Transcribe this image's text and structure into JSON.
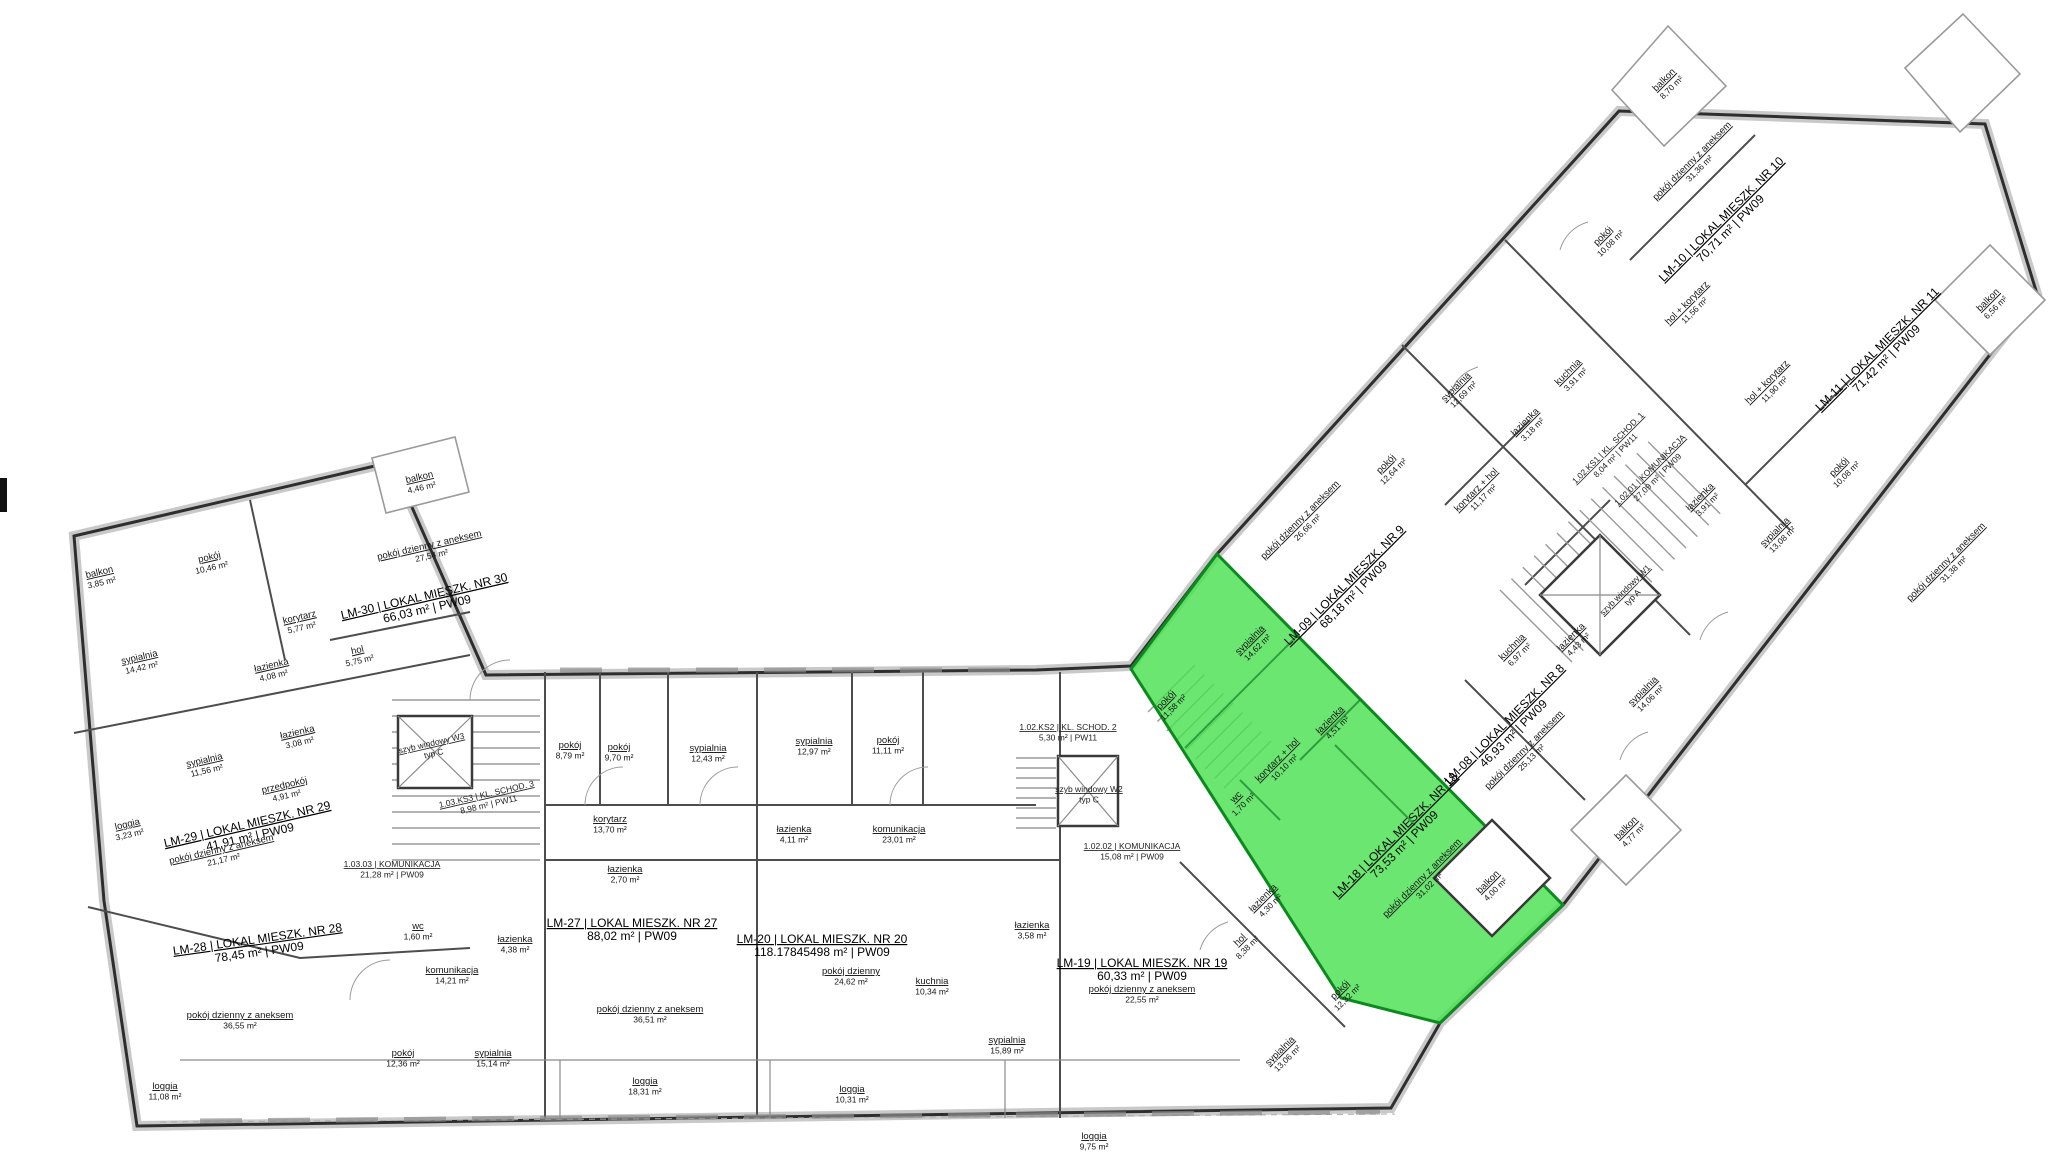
{
  "page": {
    "background": "#ffffff"
  },
  "colors": {
    "highlight_fill": "#49e052",
    "highlight_stroke": "#0c8a1e",
    "wall": "#2e2e2e"
  },
  "highlighted_unit": "lm18",
  "units": {
    "lm30": {
      "title": "LM-30 | LOKAL MIESZK. NR 30",
      "area": "66,03 m² | PW09",
      "rooms": {
        "balkon1": {
          "n": "balkon",
          "a": "4,46 m²"
        },
        "balkon2": {
          "n": "balkon",
          "a": "3,85 m²"
        },
        "pokoj": {
          "n": "pokój",
          "a": "10,46 m²"
        },
        "sypialnia": {
          "n": "sypialnia",
          "a": "14,42 m²"
        },
        "korytarz": {
          "n": "korytarz",
          "a": "5,77 m²"
        },
        "lazienka": {
          "n": "łazienka",
          "a": "4,08 m²"
        },
        "hol": {
          "n": "hol",
          "a": "5,75 m²"
        },
        "dzienny": {
          "n": "pokój dzienny z aneksem",
          "a": "27,54 m²"
        }
      }
    },
    "lm29": {
      "title": "LM-29 | LOKAL MIESZK. NR 29",
      "area": "41,91 m² | PW09",
      "rooms": {
        "sypialnia": {
          "n": "sypialnia",
          "a": "11,56 m²"
        },
        "lazienka": {
          "n": "łazienka",
          "a": "3,08 m²"
        },
        "przedpokoj": {
          "n": "przedpokój",
          "a": "4,91 m²"
        },
        "dzienny": {
          "n": "pokój dzienny z aneksem",
          "a": "21,17 m²"
        },
        "loggia": {
          "n": "loggia",
          "a": "3,23 m²"
        }
      }
    },
    "lm28": {
      "title": "LM-28 | LOKAL MIESZK. NR 28",
      "area": "78,45 m² | PW09",
      "rooms": {
        "dzienny": {
          "n": "pokój dzienny z aneksem",
          "a": "36,55 m²"
        },
        "loggia": {
          "n": "loggia",
          "a": "11,08 m²"
        },
        "wc": {
          "n": "wc",
          "a": "1,60 m²"
        },
        "lazienka": {
          "n": "łazienka",
          "a": "4,38 m²"
        },
        "komunikacja": {
          "n": "komunikacja",
          "a": "14,21 m²"
        },
        "pokoj": {
          "n": "pokój",
          "a": "12,36 m²"
        },
        "sypialnia": {
          "n": "sypialnia",
          "a": "15,14 m²"
        }
      }
    },
    "lm27": {
      "title": "LM-27 | LOKAL MIESZK. NR 27",
      "area": "88,02 m² | PW09",
      "rooms": {
        "pokoj1": {
          "n": "pokój",
          "a": "8,79 m²"
        },
        "pokoj2": {
          "n": "pokój",
          "a": "9,70 m²"
        },
        "sypialnia": {
          "n": "sypialnia",
          "a": "12,43 m²"
        },
        "korytarz": {
          "n": "korytarz",
          "a": "13,70 m²"
        },
        "lazienka": {
          "n": "łazienka",
          "a": "2,70 m²"
        },
        "dzienny": {
          "n": "pokój dzienny z aneksem",
          "a": "36,51 m²"
        },
        "loggia": {
          "n": "loggia",
          "a": "18,31 m²"
        }
      }
    },
    "lm20": {
      "title": "LM-20 | LOKAL MIESZK. NR 20",
      "area": "118.17845498 m² | PW09",
      "rooms": {
        "sypialnia1": {
          "n": "sypialnia",
          "a": "12,97 m²"
        },
        "pokoj": {
          "n": "pokój",
          "a": "11,11 m²"
        },
        "lazienka1": {
          "n": "łazienka",
          "a": "4,11 m²"
        },
        "komunikacja": {
          "n": "komunikacja",
          "a": "23,01 m²"
        },
        "dzienny": {
          "n": "pokój dzienny",
          "a": "24,62 m²"
        },
        "kuchnia": {
          "n": "kuchnia",
          "a": "10,34 m²"
        },
        "lazienka2": {
          "n": "łazienka",
          "a": "3,58 m²"
        },
        "sypialnia2": {
          "n": "sypialnia",
          "a": "15,89 m²"
        },
        "loggia": {
          "n": "loggia",
          "a": "10,31 m²"
        }
      }
    },
    "lm19": {
      "title": "LM-19 | LOKAL MIESZK. NR 19",
      "area": "60,33 m² | PW09",
      "rooms": {
        "dzienny": {
          "n": "pokój dzienny z aneksem",
          "a": "22,55 m²"
        },
        "lazienka": {
          "n": "łazienka",
          "a": "4,30 m²"
        },
        "hol": {
          "n": "hol",
          "a": "8,38 m²"
        },
        "pokoj": {
          "n": "pokój",
          "a": "12,32 m²"
        },
        "sypialnia": {
          "n": "sypialnia",
          "a": "13,06 m²"
        },
        "loggia": {
          "n": "loggia",
          "a": "9,75 m²"
        }
      }
    },
    "lm18": {
      "title": "LM-18 | LOKAL MIESZK. NR 18",
      "area": "73,53 m² | PW09",
      "rooms": {
        "sypialnia": {
          "n": "sypialnia",
          "a": "14,62 m²"
        },
        "pokoj": {
          "n": "pokój",
          "a": "11,58 m²"
        },
        "korytarz": {
          "n": "korytarz + hol",
          "a": "10,10 m²"
        },
        "wc": {
          "n": "wc",
          "a": "1,70 m²"
        },
        "lazienka": {
          "n": "łazienka",
          "a": "4,51 m²"
        },
        "dzienny": {
          "n": "pokój dzienny z aneksem",
          "a": "31,02 m²"
        },
        "balkon": {
          "n": "balkon",
          "a": "4,00 m²"
        }
      }
    },
    "lm10": {
      "title": "LM-10 | LOKAL MIESZK. NR 10",
      "area": "70,71 m² | PW09",
      "rooms": {
        "balkon": {
          "n": "balkon",
          "a": "8,70 m²"
        },
        "dzienny": {
          "n": "pokój dzienny z aneksem",
          "a": "31,36 m²"
        },
        "pokoj": {
          "n": "pokój",
          "a": "10,08 m²"
        },
        "hol": {
          "n": "hol + korytarz",
          "a": "11,56 m²"
        }
      }
    },
    "lm11": {
      "title": "LM-11 | LOKAL MIESZK. NR 11",
      "area": "71,42 m² | PW09",
      "rooms": {
        "balkon": {
          "n": "balkon",
          "a": "6,56 m²"
        },
        "hol": {
          "n": "hol + korytarz",
          "a": "11,90 m²"
        },
        "pokoj": {
          "n": "pokój",
          "a": "10,08 m²"
        },
        "sypialnia": {
          "n": "sypialnia",
          "a": "13,08 m²"
        },
        "lazienka": {
          "n": "łazienka",
          "a": "3,91 m²"
        },
        "dzienny": {
          "n": "pokój dzienny z aneksem",
          "a": "31,38 m²"
        }
      }
    },
    "lm09": {
      "title": "LM-09 | LOKAL MIESZK. NR 9",
      "area": "68,18 m² | PW09",
      "rooms": {
        "dzienny": {
          "n": "pokój dzienny z aneksem",
          "a": "26,66 m²"
        },
        "sypialnia": {
          "n": "sypialnia",
          "a": "12,69 m²"
        },
        "pokoj": {
          "n": "pokój",
          "a": "12,64 m²"
        },
        "kuchnia": {
          "n": "kuchnia",
          "a": "3,91 m²"
        },
        "lazienka": {
          "n": "łazienka",
          "a": "3,18 m²"
        },
        "korytarz": {
          "n": "korytarz + hol",
          "a": "11,17 m²"
        }
      }
    },
    "lm08": {
      "title": "LM-08 | LOKAL MIESZK. NR 8",
      "area": "46,93 m² | PW09",
      "rooms": {
        "dzienny": {
          "n": "pokój dzienny z aneksem",
          "a": "25,13 m²"
        },
        "sypialnia": {
          "n": "sypialnia",
          "a": "14,06 m²"
        },
        "lazienka": {
          "n": "łazienka",
          "a": "4,43 m²"
        },
        "kuchnia": {
          "n": "kuchnia",
          "a": "6,97 m²"
        },
        "balkon": {
          "n": "balkon",
          "a": "4,77 m²"
        }
      }
    }
  },
  "circ": {
    "kom103": {
      "t1": "1.03.03 | KOMUNIKACJA",
      "t2": "21,28 m² | PW09"
    },
    "ks3": {
      "t1": "1.03.KS3 | KL. SCHOD. 3",
      "t2": "8,98 m² | PW11"
    },
    "w3": {
      "t1": "szyb windowy W3",
      "t2": "typ C"
    },
    "ks2": {
      "t1": "1.02.KS2 | KL. SCHOD. 2",
      "t2": "5,30 m² | PW11"
    },
    "w2": {
      "t1": "szyb windowy W2",
      "t2": "typ C"
    },
    "kom102": {
      "t1": "1.02.02 | KOMUNIKACJA",
      "t2": "15,08 m² | PW09"
    },
    "ks1": {
      "t1": "1.02.KS1 | KL. SCHOD. 1",
      "t2": "8,04 m² | PW11"
    },
    "kom1021": {
      "t1": "1.02.01 | KOMUNIKACJA",
      "t2": "27,09 m² | PW09"
    },
    "w1": {
      "t1": "szyb windowy W1",
      "t2": "typ A"
    }
  }
}
